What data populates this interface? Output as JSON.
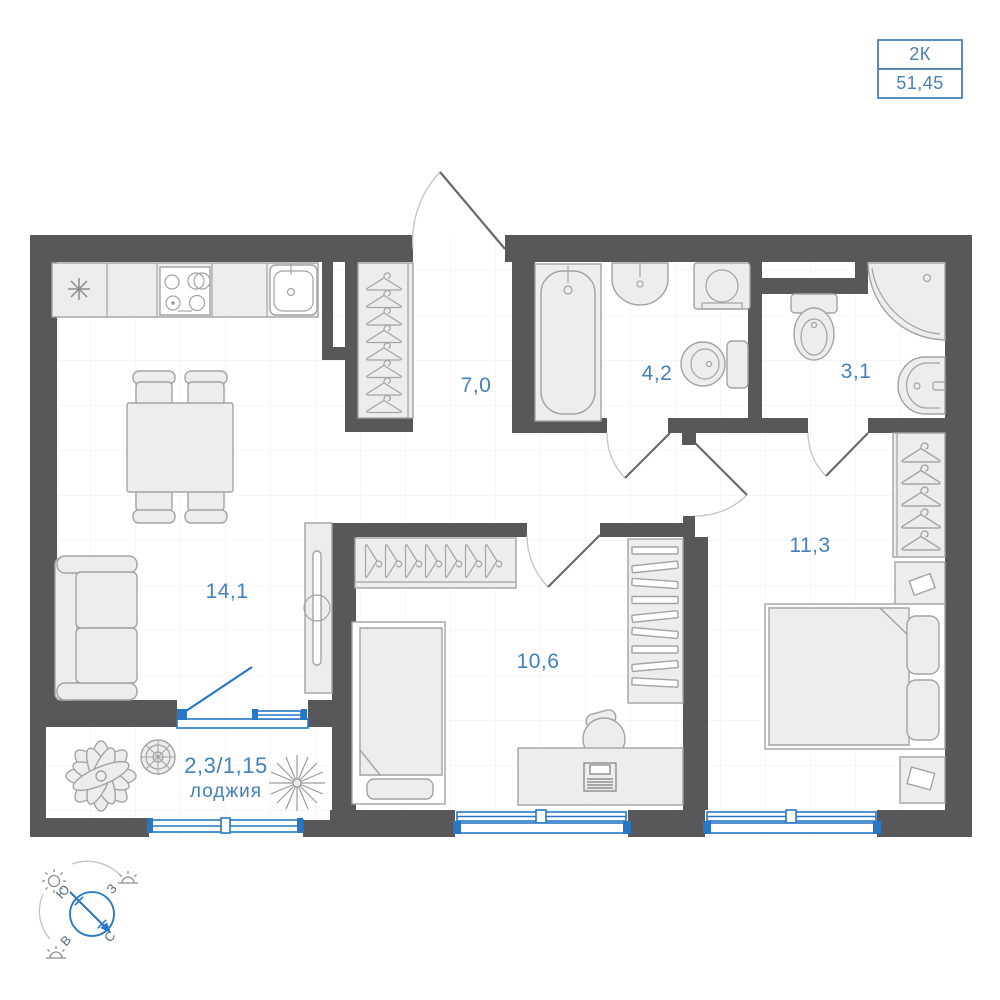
{
  "plan": {
    "badge": {
      "rooms_label": "2К",
      "total_area": "51,45"
    },
    "room_labels": {
      "hallway": "7,0",
      "bathroom": "4,2",
      "toilet": "3,1",
      "bedroom": "11,3",
      "child_room": "10,6",
      "living_room": "14,1",
      "loggia_area": "2,3/1,15",
      "loggia_name": "лоджия"
    },
    "compass": {
      "south": "Ю",
      "west": "З",
      "east": "В",
      "north": "С"
    },
    "colors": {
      "wall": "#58585a",
      "accent_blue": "#2777c4",
      "label_blue": "#4381bc",
      "furniture_fill": "#ededed",
      "furniture_stroke": "#a3a3a3",
      "floor_grid": "#eef2f7",
      "badge_border": "#4a80b8"
    }
  }
}
